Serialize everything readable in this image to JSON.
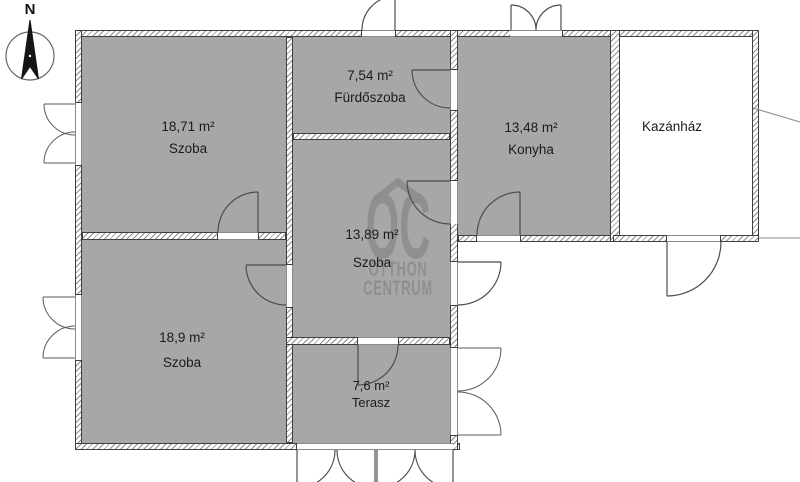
{
  "compass": {
    "north_label": "N"
  },
  "rooms": [
    {
      "id": "szoba-nw",
      "area": "18,71 m²",
      "name": "Szoba"
    },
    {
      "id": "furdoszoba",
      "area": "7,54 m²",
      "name": "Fürdőszoba"
    },
    {
      "id": "konyha",
      "area": "13,48 m²",
      "name": "Konyha"
    },
    {
      "id": "kazanhaz",
      "area": "",
      "name": "Kazánház"
    },
    {
      "id": "szoba-center",
      "area": "13,89 m²",
      "name": "Szoba"
    },
    {
      "id": "szoba-sw",
      "area": "18,9 m²",
      "name": "Szoba"
    },
    {
      "id": "terasz",
      "area": "7,6 m²",
      "name": "Terasz"
    }
  ],
  "watermark": {
    "logo": "OC",
    "line1": "OTTHON",
    "line2": "CENTRUM"
  },
  "colors": {
    "room_fill": "#a7a7a7",
    "wall_outline": "#3f3f3f",
    "hatch_line": "#8d8d8d",
    "symbol_line": "#4d4d4d",
    "watermark_gray": "#8f8f8f",
    "label_text": "#1b1b1b"
  }
}
